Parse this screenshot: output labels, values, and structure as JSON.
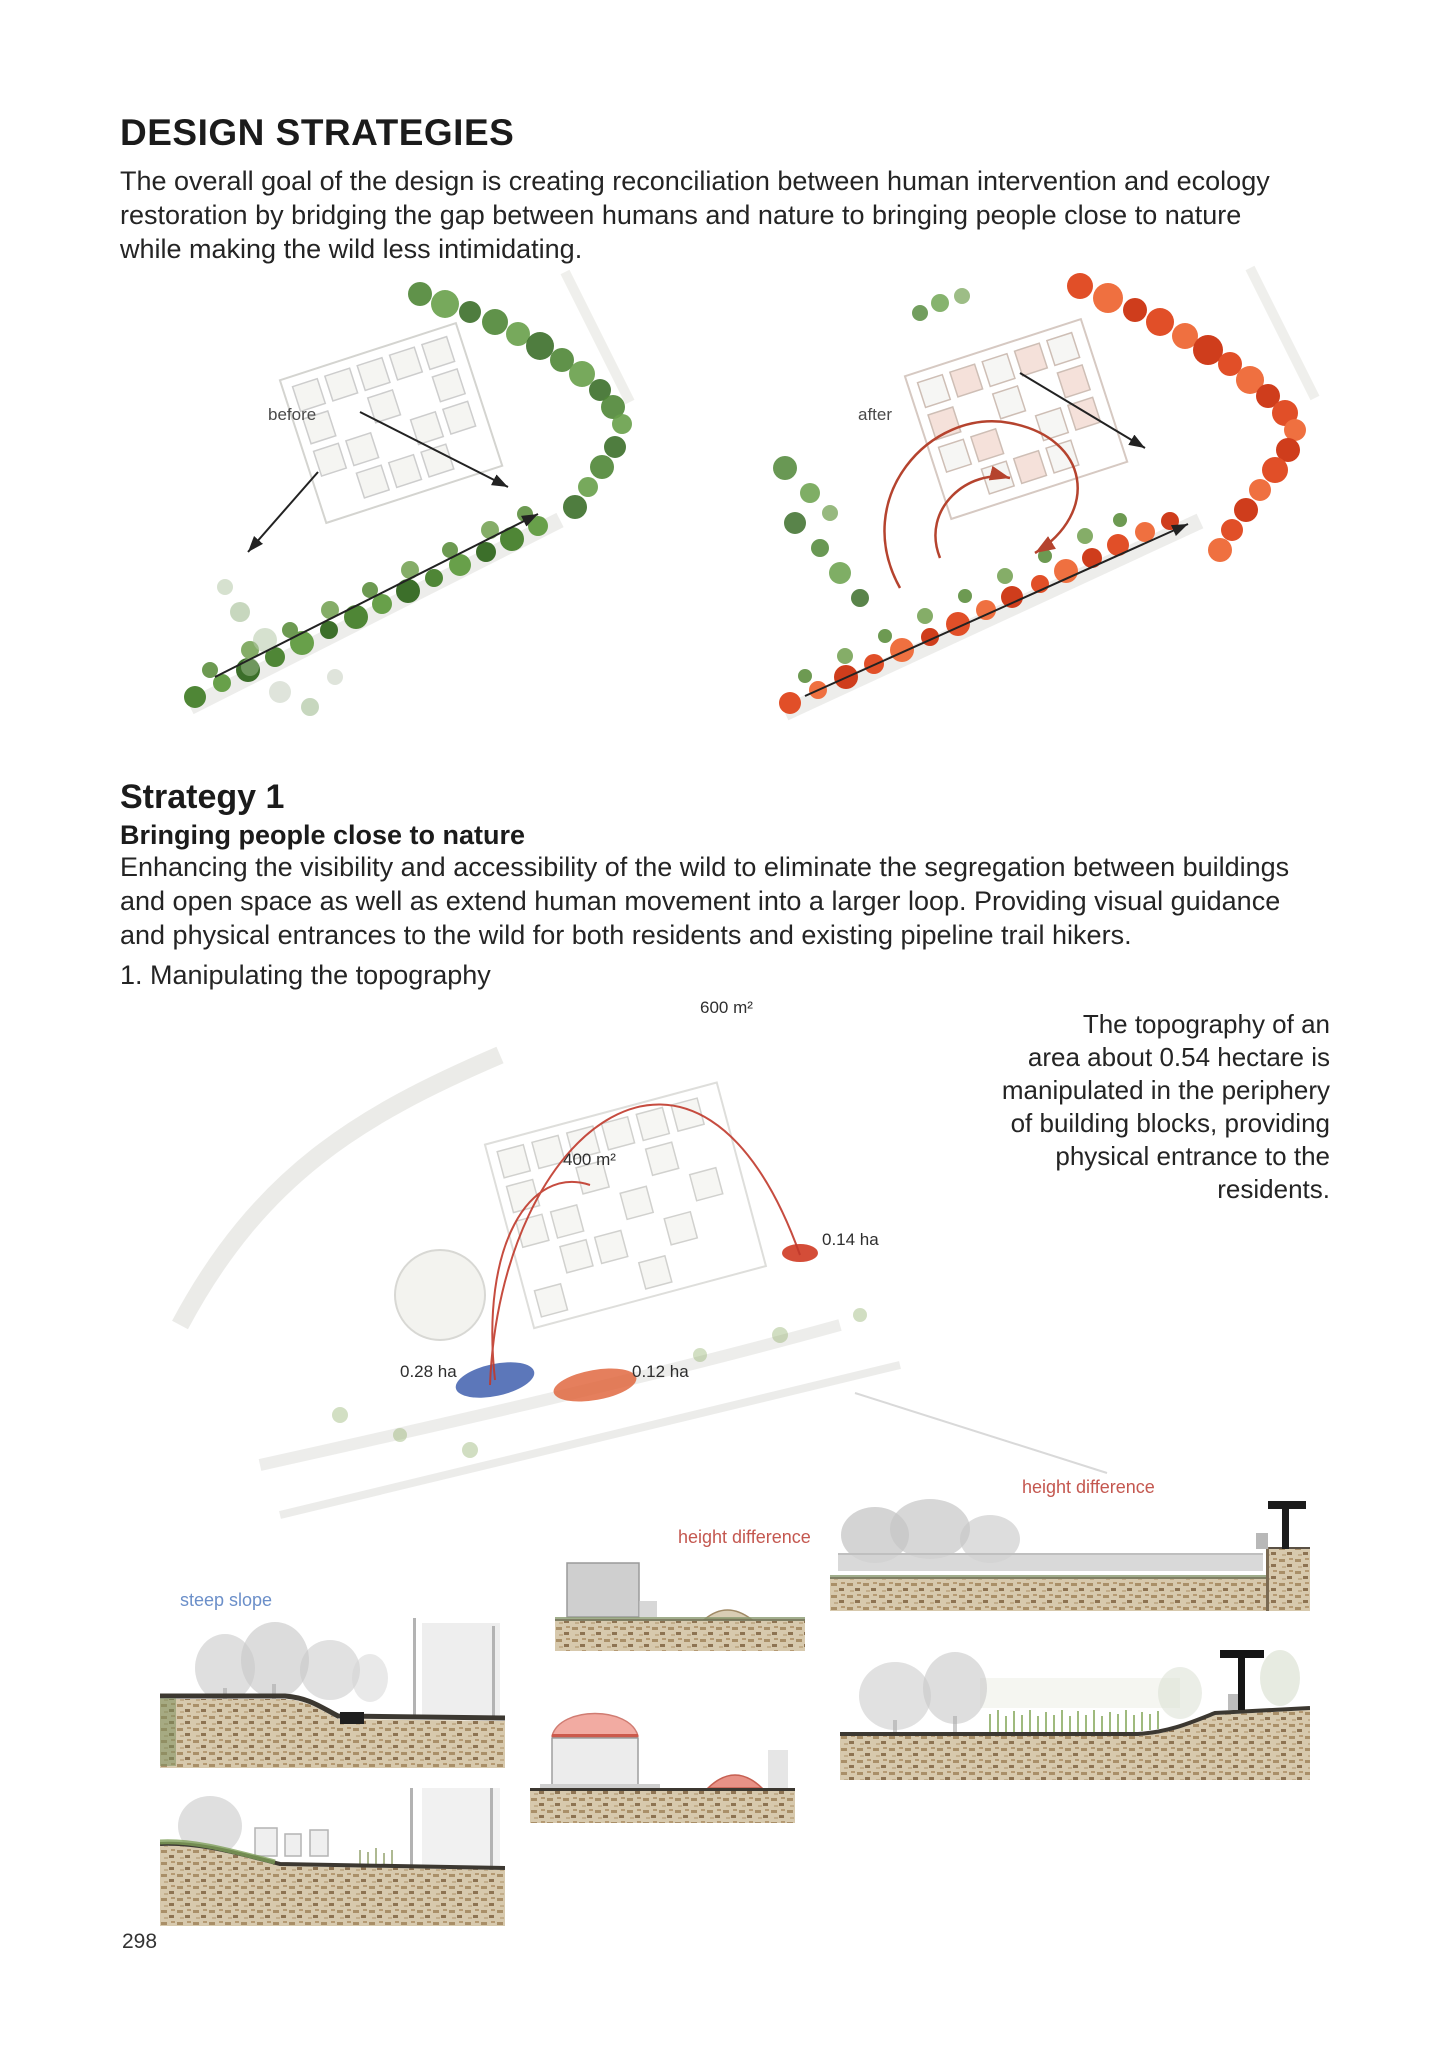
{
  "header": {
    "title": "DESIGN STRATEGIES",
    "intro": "The overall goal of the design is creating reconciliation between human intervention and ecology\nrestoration by bridging the gap between humans and nature to bringing people close to nature\nwhile making the wild less intimidating."
  },
  "before_after": {
    "before_label": "before",
    "after_label": "after"
  },
  "strategy": {
    "heading": "Strategy 1",
    "subheading": "Bringing people close to nature",
    "body": "Enhancing the visibility and accessibility of the wild to eliminate the segregation between buildings\nand open space as well as extend human movement into a larger loop. Providing visual guidance\nand physical entrances to the wild for both residents and existing pipeline trail hikers.",
    "step1": "1. Manipulating the topography"
  },
  "topo_diagram": {
    "labels": {
      "area_600": "600 m²",
      "area_400": "400 m²",
      "ha_014": "0.14 ha",
      "ha_028": "0.28 ha",
      "ha_012": "0.12 ha"
    },
    "caption": "The topography of an\narea about 0.54 hectare is\nmanipulated in the periphery\nof building blocks, providing\nphysical entrance to the\nresidents."
  },
  "sections": {
    "steep_slope_label": "steep slope",
    "height_difference_label_mid": "height difference",
    "height_difference_label_right": "height difference"
  },
  "footer": {
    "page_number": "298"
  },
  "colors": {
    "green_tree": "#4f8636",
    "red_tree": "#e14f28",
    "red_annotation": "#c4574f",
    "blue_annotation": "#6b8fc9",
    "arc_red": "#c0392b",
    "patch_blue": "#3f5fae",
    "patch_orange": "#df5f35",
    "ground_brown": "#d7c9ad"
  }
}
